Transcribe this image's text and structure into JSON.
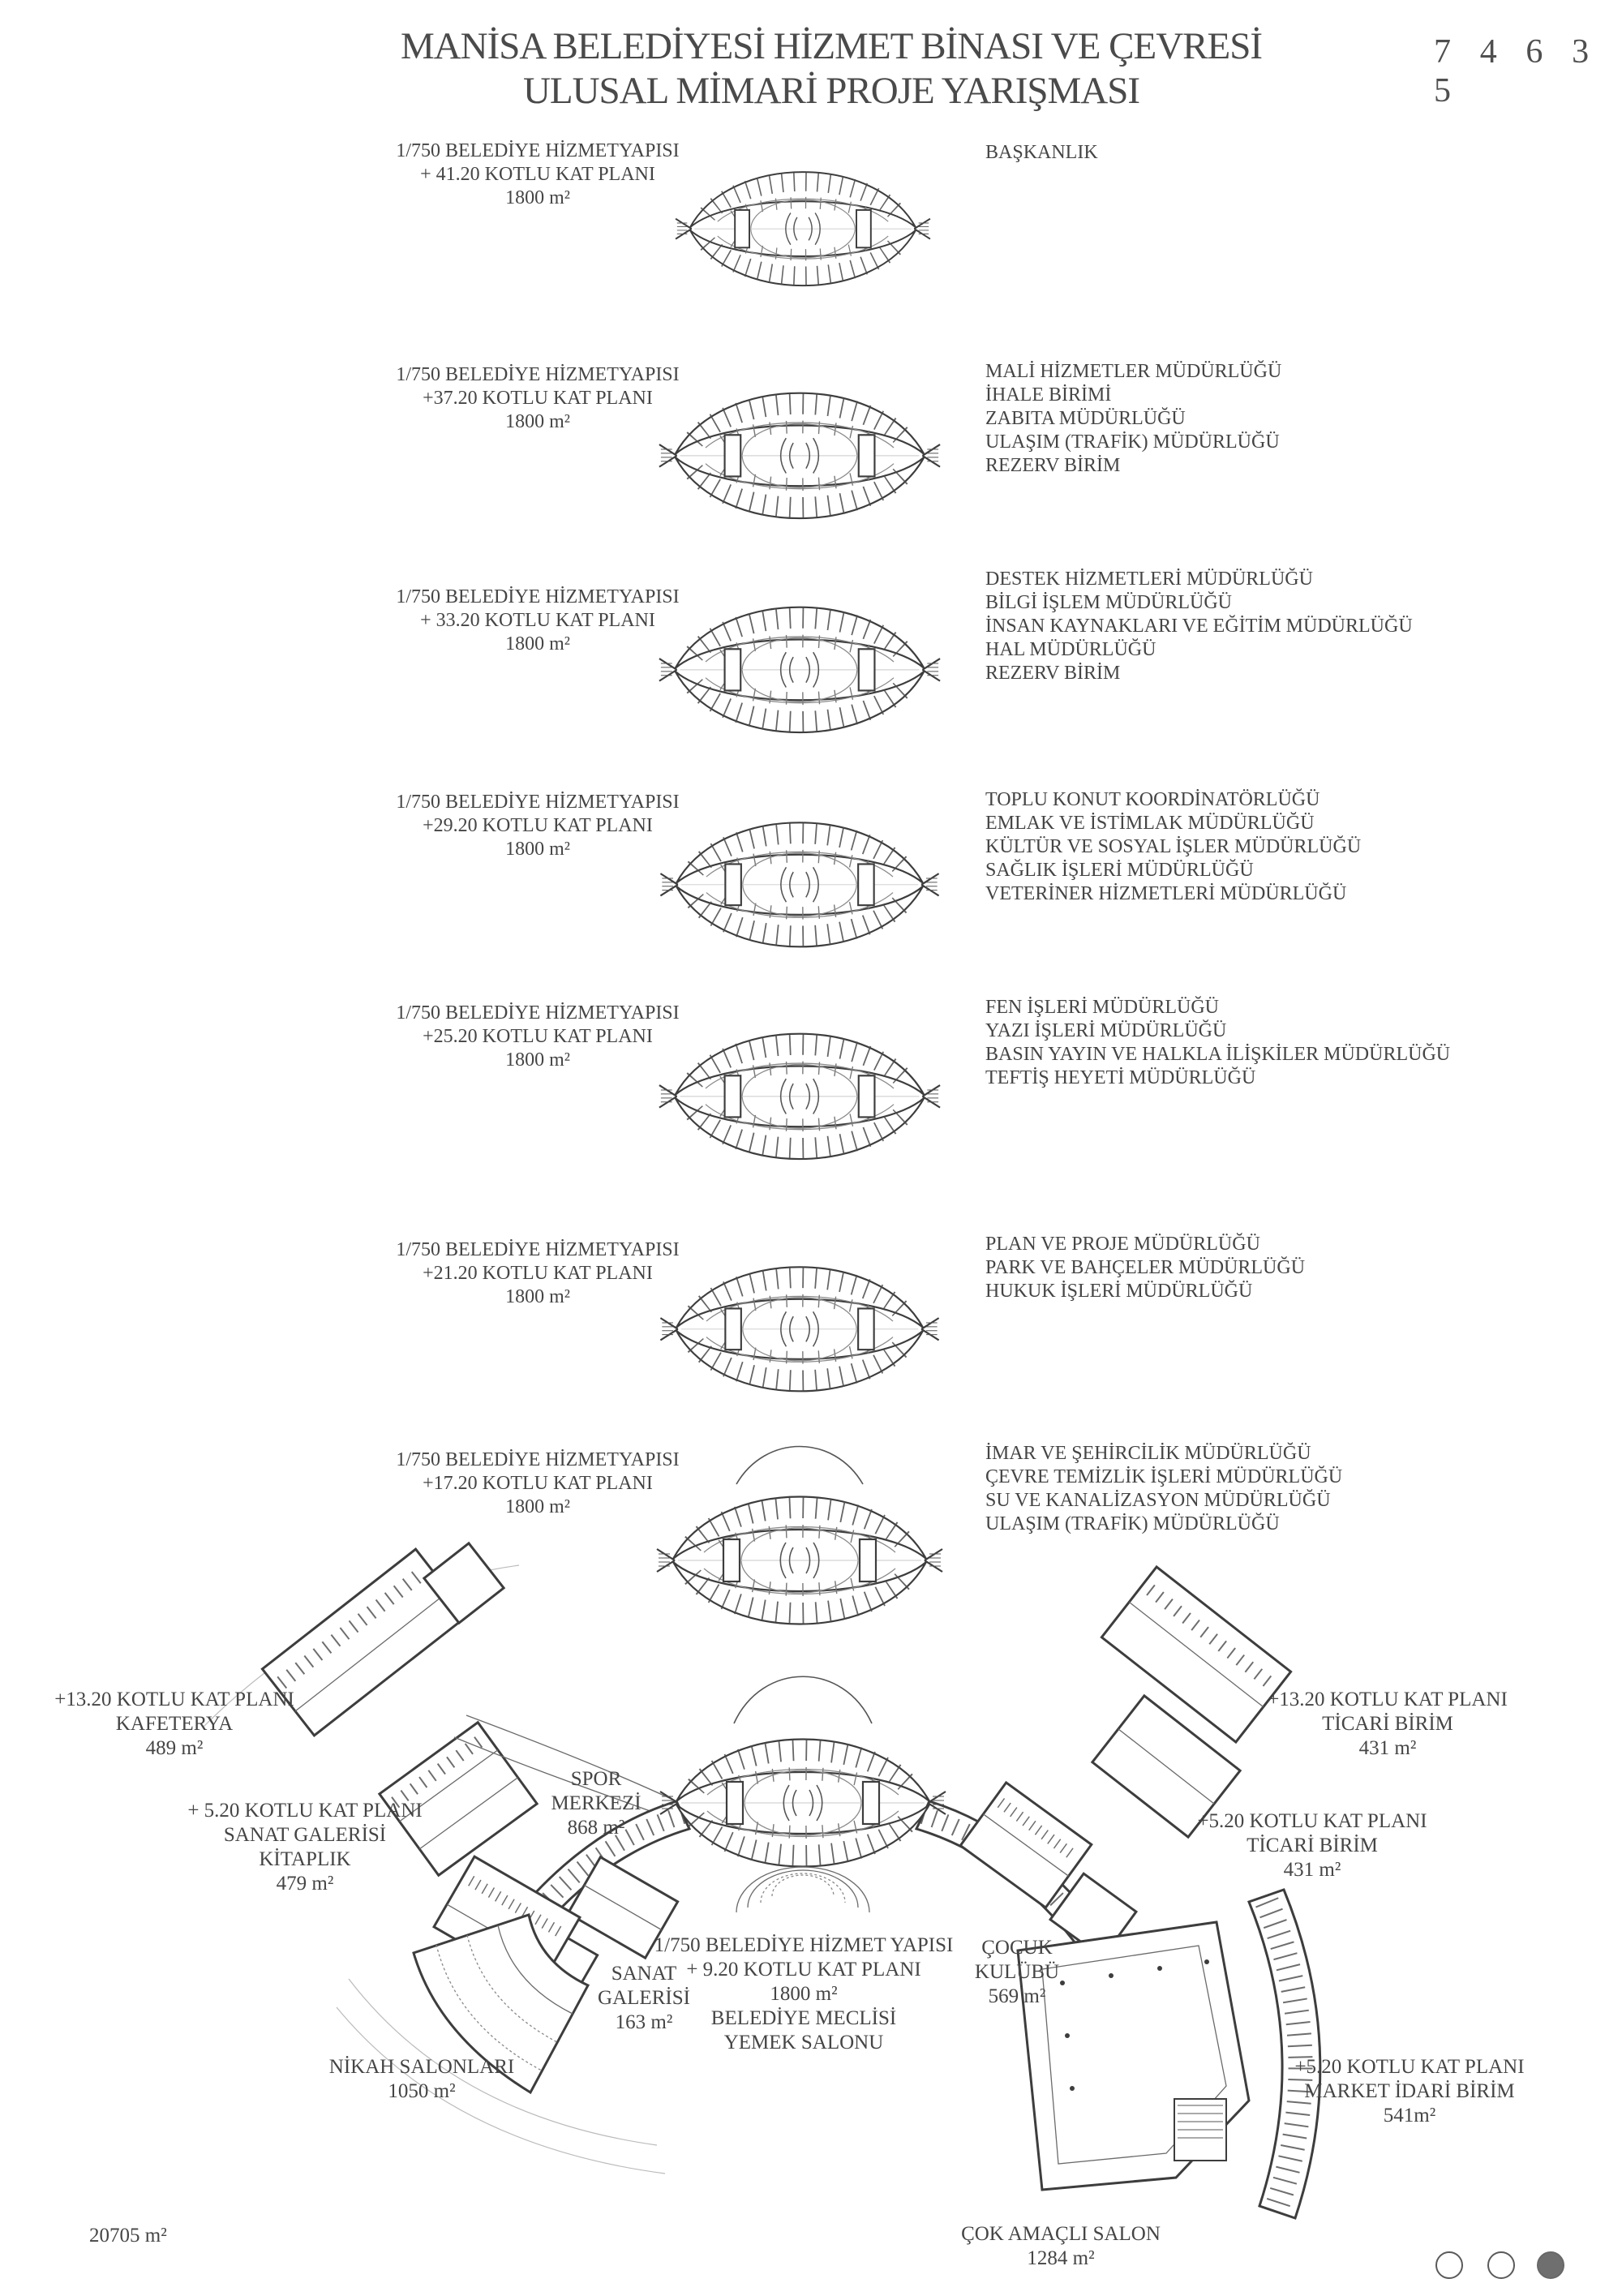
{
  "header": {
    "title_line1": "MANİSA BELEDİYESİ HİZMET BİNASI VE ÇEVRESİ",
    "title_line2": "ULUSAL MİMARİ PROJE YARIŞMASI",
    "competition_number": "7 4 6 3 5"
  },
  "floors": [
    {
      "scale_line": "1/750 BELEDİYE HİZMETYAPISI",
      "level_line": "+ 41.20 KOTLU KAT PLANI",
      "area": "1800 m²",
      "departments": [
        "BAŞKANLIK"
      ]
    },
    {
      "scale_line": "1/750 BELEDİYE HİZMETYAPISI",
      "level_line": "+37.20 KOTLU KAT PLANI",
      "area": "1800 m²",
      "departments": [
        "MALİ HİZMETLER MÜDÜRLÜĞÜ",
        "İHALE BİRİMİ",
        "ZABITA MÜDÜRLÜĞÜ",
        "ULAŞIM (TRAFİK) MÜDÜRLÜĞÜ",
        "REZERV BİRİM"
      ]
    },
    {
      "scale_line": "1/750 BELEDİYE HİZMETYAPISI",
      "level_line": "+ 33.20 KOTLU KAT PLANI",
      "area": "1800 m²",
      "departments": [
        "DESTEK HİZMETLERİ MÜDÜRLÜĞÜ",
        "BİLGİ İŞLEM MÜDÜRLÜĞÜ",
        "İNSAN KAYNAKLARI VE EĞİTİM MÜDÜRLÜĞÜ",
        "HAL MÜDÜRLÜĞÜ",
        "REZERV BİRİM"
      ]
    },
    {
      "scale_line": "1/750 BELEDİYE HİZMETYAPISI",
      "level_line": "+29.20 KOTLU KAT PLANI",
      "area": "1800 m²",
      "departments": [
        "TOPLU KONUT KOORDİNATÖRLÜĞÜ",
        "EMLAK VE İSTİMLAK MÜDÜRLÜĞÜ",
        "KÜLTÜR VE SOSYAL İŞLER MÜDÜRLÜĞÜ",
        "SAĞLIK İŞLERİ MÜDÜRLÜĞÜ",
        "VETERİNER HİZMETLERİ MÜDÜRLÜĞÜ"
      ]
    },
    {
      "scale_line": "1/750 BELEDİYE HİZMETYAPISI",
      "level_line": "+25.20 KOTLU KAT PLANI",
      "area": "1800 m²",
      "departments": [
        "FEN İŞLERİ MÜDÜRLÜĞÜ",
        "YAZI İŞLERİ MÜDÜRLÜĞÜ",
        "BASIN YAYIN VE HALKLA İLİŞKİLER MÜDÜRLÜĞÜ",
        "TEFTİŞ HEYETİ MÜDÜRLÜĞÜ"
      ]
    },
    {
      "scale_line": "1/750 BELEDİYE HİZMETYAPISI",
      "level_line": "+21.20 KOTLU KAT PLANI",
      "area": "1800 m²",
      "departments": [
        "PLAN VE PROJE MÜDÜRLÜĞÜ",
        "PARK VE BAHÇELER MÜDÜRLÜĞÜ",
        "HUKUK İŞLERİ MÜDÜRLÜĞÜ"
      ]
    },
    {
      "scale_line": "1/750 BELEDİYE HİZMETYAPISI",
      "level_line": "+17.20 KOTLU KAT PLANI",
      "area": "1800 m²",
      "departments": [
        "İMAR VE ŞEHİRCİLİK MÜDÜRLÜĞÜ",
        "ÇEVRE TEMİZLİK İŞLERİ MÜDÜRLÜĞÜ",
        "SU VE KANALİZASYON MÜDÜRLÜĞÜ",
        "ULAŞIM (TRAFİK) MÜDÜRLÜĞÜ"
      ]
    }
  ],
  "site": {
    "kafeterya": {
      "lines": [
        "+13.20 KOTLU KAT PLANI",
        "KAFETERYA",
        "489 m²"
      ]
    },
    "sanat_galerisi_kitaplik": {
      "lines": [
        "+ 5.20 KOTLU KAT PLANI",
        "SANAT GALERİSİ",
        "KİTAPLIK",
        "479 m²"
      ]
    },
    "spor_merkezi": {
      "lines": [
        "SPOR",
        "MERKEZİ",
        "868 m²"
      ]
    },
    "sanat_galerisi": {
      "lines": [
        "SANAT",
        "GALERİSİ",
        "163 m²"
      ]
    },
    "belediye_meclisi": {
      "lines": [
        "1/750 BELEDİYE HİZMET YAPISI",
        "+ 9.20 KOTLU KAT PLANI",
        "1800 m²",
        "BELEDİYE MECLİSİ",
        "YEMEK SALONU"
      ]
    },
    "cocuk_kulubu": {
      "lines": [
        "ÇOCUK",
        "KULÜBÜ",
        "569 m²"
      ]
    },
    "ticari_birim_1320": {
      "lines": [
        "+13.20 KOTLU KAT PLANI",
        "TİCARİ BİRİM",
        "431 m²"
      ]
    },
    "ticari_birim_520": {
      "lines": [
        "+5.20 KOTLU KAT PLANI",
        "TİCARİ BİRİM",
        "431 m²"
      ]
    },
    "market_idari_birim": {
      "lines": [
        "+5.20 KOTLU KAT PLANI",
        "MARKET İDARİ BİRİM",
        "541m²"
      ]
    },
    "nikah_salonlari": {
      "lines": [
        "NİKAH SALONLARI",
        "1050 m²"
      ]
    },
    "cok_amacli_salon": {
      "lines": [
        "ÇOK AMAÇLI SALON",
        "1284 m²"
      ]
    },
    "total_area": "20705 m²"
  },
  "page_indicator": {
    "dots": [
      "empty",
      "empty",
      "filled"
    ],
    "active_color": "#6f6f6f"
  },
  "colors": {
    "text": "#454545",
    "linework": "#3d3d3d",
    "background": "#ffffff"
  }
}
